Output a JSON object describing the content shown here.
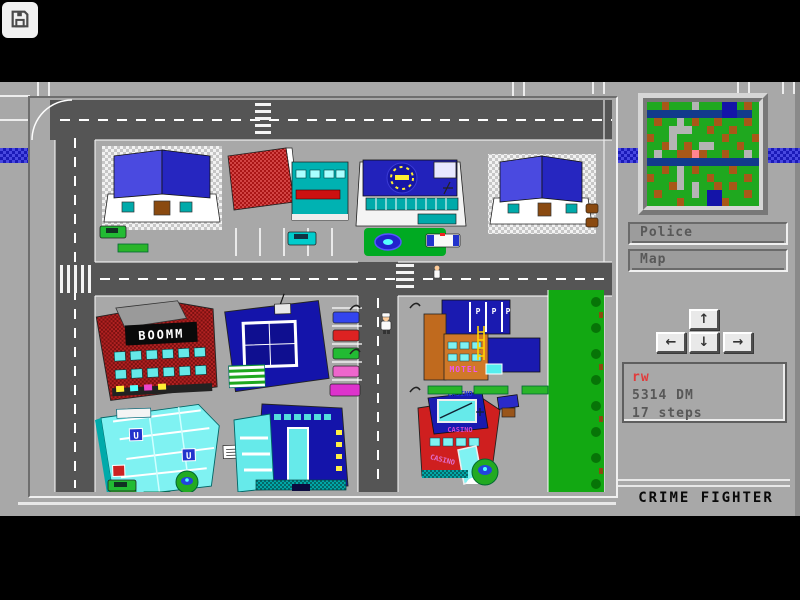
{
  "overlay": {
    "save_button": {
      "icon": "floppy-disk-icon"
    },
    "drawer_handle": {
      "icon": "chevron-right-icon",
      "glyph": "›"
    }
  },
  "hud": {
    "minimap": {
      "palette": {
        "G": "#1fa81f",
        "b": "#a85818",
        "B": "#1414a8",
        "r": "#b4b4b4",
        "d": "#123a8c",
        "p": "#ff8490"
      },
      "grid": [
        "GGbGGGrGGGBBGbG",
        "ddddddddddBBddG",
        "GbGGrGbGGbGGGbG",
        "GGGrrrGGbGGbGGG",
        "bGGrGGGGGGbGGGb",
        "GGbrGbGrrGGGbGG",
        "GrGGbbpbGGbGGrG",
        "ddddddddddddddd",
        "GGbGrGbGGGGbGGG",
        "bGGGrGGGbGGGGbG",
        "GGGbrGrGGbGbGGG",
        "GbGGGGrGBBGGGbG",
        "GGGGbGGGBBbGGGG"
      ]
    },
    "buttons": [
      {
        "id": "police",
        "label": "Police"
      },
      {
        "id": "map",
        "label": "Map"
      }
    ],
    "dpad": {
      "up": "↑",
      "left": "←",
      "down": "↓",
      "right": "→"
    },
    "status": {
      "player_name": "rw",
      "money": "5314 DM",
      "steps": "17 steps"
    },
    "title": "CRIME FIGHTER"
  },
  "city": {
    "signs": {
      "boomm": "BOOMM",
      "motel": "MOTEL",
      "casino": "CASINO",
      "parking": "P",
      "subway": "U"
    },
    "colors": {
      "panel_gray": "#a8a8a8",
      "road_gray": "#555555",
      "stripe_blue": "#1a1ab8",
      "roof_blue": "#2626c0",
      "window_teal": "#00aaaa",
      "brick_red": "#b22222",
      "park_green": "#1fa81f",
      "status_red": "#e23b3b"
    }
  }
}
